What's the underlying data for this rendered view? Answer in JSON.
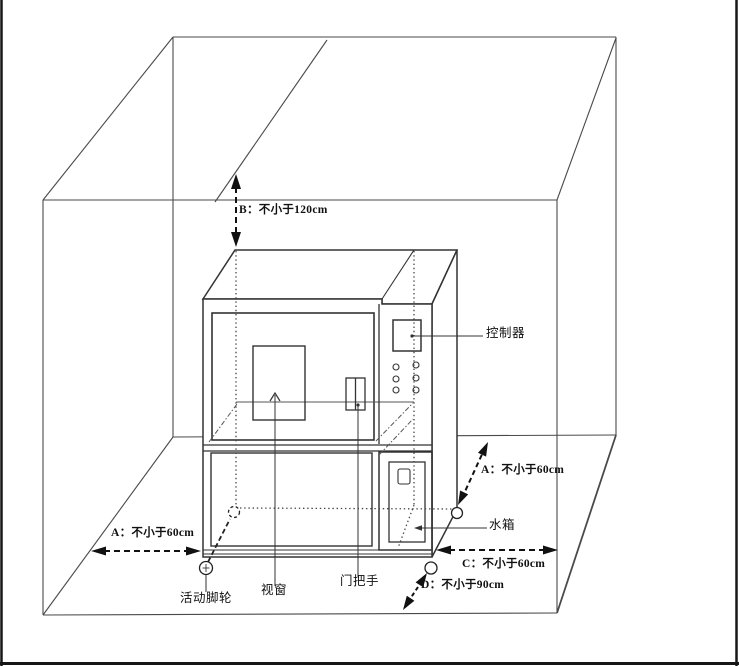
{
  "diagram": {
    "title": "设备安装间距示意图",
    "dimensions": {
      "b": "B：不小于120cm",
      "a_left": "A：不小于60cm",
      "a_right": "A：不小于60cm",
      "c": "C：不小于60cm",
      "d": "D：不小于90cm"
    },
    "parts": {
      "controller": "控制器",
      "water_tank": "水箱",
      "caster": "活动脚轮",
      "viewport": "视窗",
      "door_handle": "门把手"
    },
    "colors": {
      "room_line": "#4a4a4a",
      "machine_line": "#333333",
      "arrow": "#111111",
      "background": "#ffffff"
    }
  }
}
